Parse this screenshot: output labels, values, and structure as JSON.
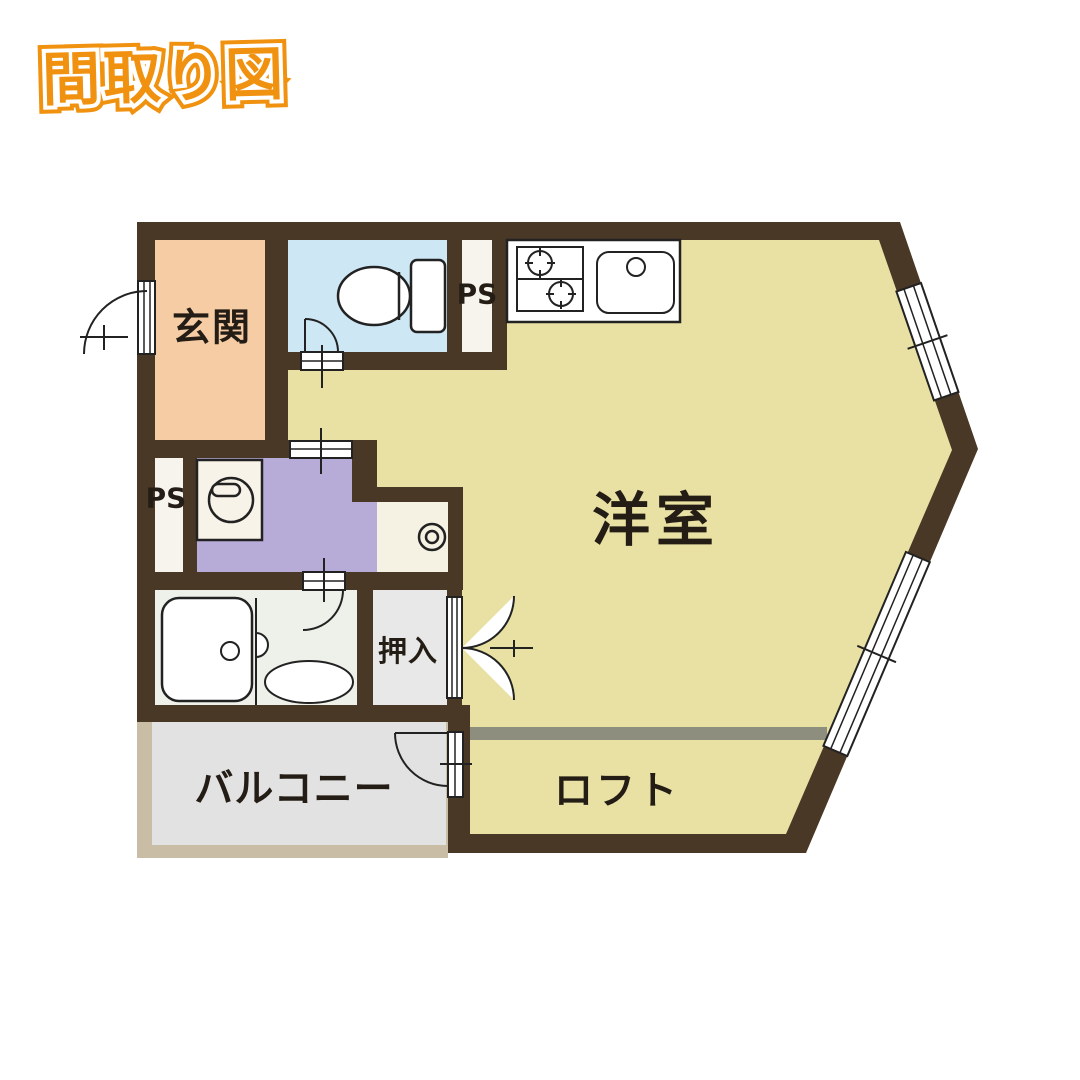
{
  "badge": {
    "label": "間取り図"
  },
  "labels": {
    "genkan": "玄関",
    "yoshitsu": "洋室",
    "oshiire": "押入",
    "balcony": "バルコニー",
    "loft": "ロフト",
    "ps_top": "PS",
    "ps_mid": "PS"
  },
  "colors": {
    "wall": "#4a3826",
    "room_yellow": "#e9e1a4",
    "genkan": "#f6cca4",
    "toilet": "#cde8f4",
    "washroom": "#b7abd8",
    "bathroom": "#eef1ea",
    "oshiire": "#e8e8e8",
    "alcove": "#f5f1e3",
    "balcony_floor": "#e2e2e2",
    "balcony_border": "#c9bda6",
    "ps": "#f7f4ee",
    "fixture_white": "#ffffff",
    "loft_line": "#8e8e7e",
    "badge_orange": "#f0920f",
    "label_text": "#241d15",
    "line": "#222222"
  }
}
